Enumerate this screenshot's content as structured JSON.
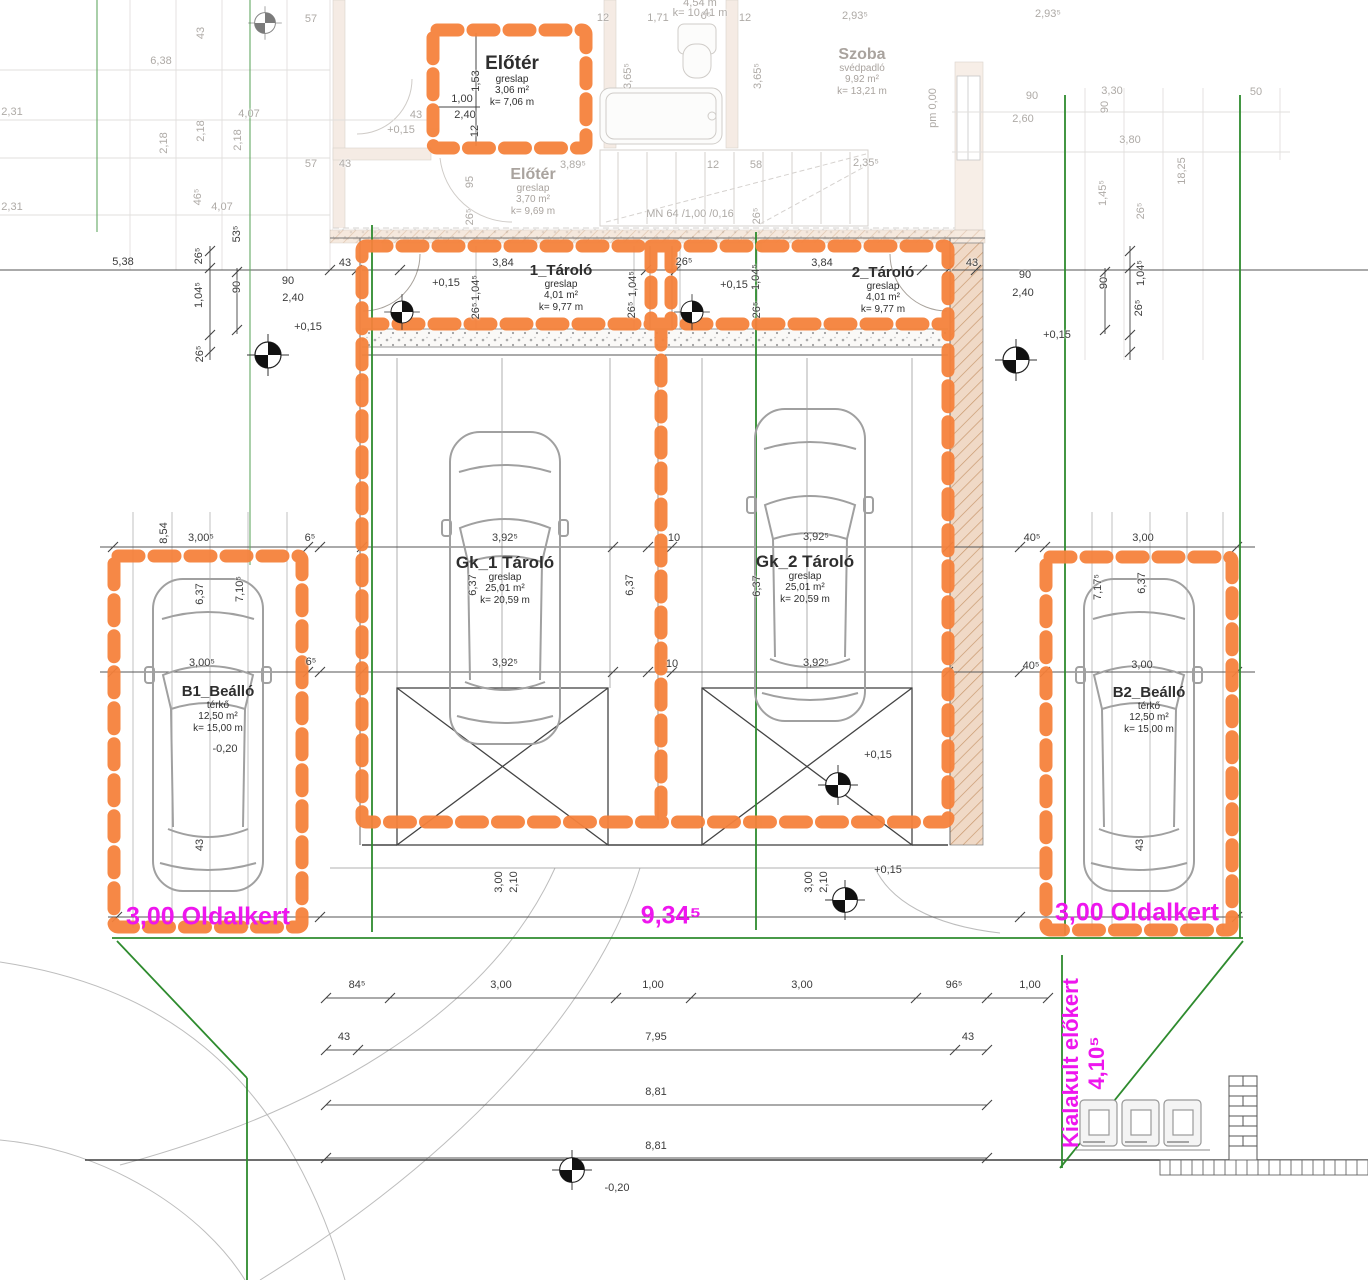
{
  "title": "Site / garage floor plan (Hungarian)",
  "colors": {
    "orange": "#F5823C",
    "magenta": "#EE16EE",
    "green": "#2E8B2E",
    "dim_dark": "#3B3B3B",
    "dim_faded": "#AEAAA6",
    "wall_tan": "#F0D9C6"
  },
  "rooms": [
    {
      "name": "room-elotere-upper",
      "cls": "elot",
      "title": "Előtér",
      "lines": [
        "greslap",
        "3,06 m²",
        "k= 7,06 m"
      ],
      "x": 512,
      "y": 54
    },
    {
      "name": "room-elotere-lower",
      "cls": "fade",
      "title": "Előtér",
      "lines": [
        "greslap",
        "3,70 m²",
        "k= 9,69 m"
      ],
      "x": 533,
      "y": 166
    },
    {
      "name": "room-szoba",
      "cls": "fade",
      "title": "Szoba",
      "lines": [
        "svédpadló",
        "9,92 m²",
        "k= 13,21 m"
      ],
      "x": 862,
      "y": 46
    },
    {
      "name": "room-tarolo-1",
      "cls": "",
      "title": "1_Tároló",
      "lines": [
        "greslap",
        "4,01 m²",
        "k= 9,77 m"
      ],
      "x": 561,
      "y": 262
    },
    {
      "name": "room-tarolo-2",
      "cls": "",
      "title": "2_Tároló",
      "lines": [
        "greslap",
        "4,01 m²",
        "k= 9,77 m"
      ],
      "x": 883,
      "y": 264
    },
    {
      "name": "room-gk1-tarolo",
      "cls": "big",
      "title": "Gk_1 Tároló",
      "lines": [
        "greslap",
        "25,01 m²",
        "k= 20,59 m"
      ],
      "x": 505,
      "y": 553
    },
    {
      "name": "room-gk2-tarolo",
      "cls": "big",
      "title": "Gk_2 Tároló",
      "lines": [
        "greslap",
        "25,01 m²",
        "k= 20,59 m"
      ],
      "x": 805,
      "y": 552
    },
    {
      "name": "room-b1-beallo",
      "cls": "",
      "title": "B1_Beálló",
      "lines": [
        "térkő",
        "12,50 m²",
        "k= 15,00 m"
      ],
      "x": 218,
      "y": 683
    },
    {
      "name": "room-b2-beallo",
      "cls": "",
      "title": "B2_Beálló",
      "lines": [
        "térkő",
        "12,50 m²",
        "k= 15,00 m"
      ],
      "x": 1149,
      "y": 684
    }
  ],
  "annotations": [
    {
      "name": "oldalkert-left-label",
      "text": "3,00 Oldalkert",
      "x": 208,
      "y": 917,
      "v": 0
    },
    {
      "name": "dim-9-34-label",
      "text": "9,34⁵",
      "x": 671,
      "y": 916,
      "v": 0
    },
    {
      "name": "oldalkert-right-label",
      "text": "3,00 Oldalkert",
      "x": 1137,
      "y": 913,
      "v": 0
    },
    {
      "name": "kialakult-elokert-label",
      "text": "Kialakult előkert",
      "x": 1071,
      "y": 1063,
      "v": 1
    },
    {
      "name": "dim-4-10-label",
      "text": "4,10⁵",
      "x": 1097,
      "y": 1063,
      "v": 1
    }
  ],
  "dims": [
    [
      "12",
      603,
      18,
      "f"
    ],
    [
      "1,71",
      658,
      18,
      "f"
    ],
    [
      "6⁵",
      706,
      16,
      "f"
    ],
    [
      "12",
      745,
      18,
      "f"
    ],
    [
      "2,93⁵",
      855,
      16,
      "f"
    ],
    [
      "2,93⁵",
      1048,
      14,
      "f"
    ],
    [
      "4,54 m",
      700,
      3,
      "f"
    ],
    [
      "k= 10,41 m",
      700,
      13,
      "f"
    ],
    [
      "3,65⁵",
      628,
      76,
      "vf"
    ],
    [
      "3,65⁵",
      758,
      76,
      "vf"
    ],
    [
      "pm 0,00",
      933,
      108,
      "vf"
    ],
    [
      "90",
      1032,
      96,
      "f"
    ],
    [
      "2,60",
      1023,
      119,
      "f"
    ],
    [
      "3,30",
      1112,
      91,
      "f"
    ],
    [
      "90",
      1105,
      107,
      "vf"
    ],
    [
      "50",
      1256,
      92,
      "f"
    ],
    [
      "3,80",
      1130,
      140,
      "f"
    ],
    [
      "1,45⁵",
      1103,
      193,
      "vf"
    ],
    [
      "26⁵",
      1141,
      211,
      "vf"
    ],
    [
      "18,25",
      1182,
      171,
      "vf"
    ],
    [
      "2,31",
      12,
      112,
      "f"
    ],
    [
      "2,31",
      12,
      207,
      "f"
    ],
    [
      "6,38",
      161,
      61,
      "f"
    ],
    [
      "43",
      201,
      33,
      "vf"
    ],
    [
      "57",
      311,
      19,
      "f"
    ],
    [
      "2,18",
      164,
      143,
      "vf"
    ],
    [
      "2,18",
      201,
      131,
      "vf"
    ],
    [
      "2,18",
      238,
      140,
      "vf"
    ],
    [
      "4,07",
      249,
      114,
      "f"
    ],
    [
      "57",
      311,
      164,
      "f"
    ],
    [
      "43",
      345,
      164,
      "f"
    ],
    [
      "+0,15",
      401,
      130,
      "f"
    ],
    [
      "43",
      416,
      115,
      "f"
    ],
    [
      "46⁵",
      198,
      197,
      "vf"
    ],
    [
      "4,07",
      222,
      207,
      "f"
    ],
    [
      "95",
      470,
      182,
      "vf"
    ],
    [
      "26⁵",
      470,
      217,
      "vf"
    ],
    [
      "3,89⁵",
      573,
      165,
      "f"
    ],
    [
      "12",
      713,
      165,
      "f"
    ],
    [
      "58",
      756,
      165,
      "f"
    ],
    [
      "2,35⁵",
      866,
      163,
      "f"
    ],
    [
      "26⁵",
      757,
      216,
      "vf"
    ],
    [
      "MN  64 /1,00 /0,16",
      690,
      214,
      "f"
    ],
    [
      "53⁵",
      237,
      234,
      "v"
    ],
    [
      "26⁵",
      199,
      256,
      "v"
    ],
    [
      "1,00",
      462,
      99,
      ""
    ],
    [
      "2,40",
      465,
      115,
      ""
    ],
    [
      "1,53",
      476,
      81,
      "v"
    ],
    [
      "12",
      475,
      131,
      "v"
    ],
    [
      "5,38",
      123,
      262,
      ""
    ],
    [
      "1,04⁵",
      199,
      295,
      "v"
    ],
    [
      "26⁵",
      200,
      354,
      "v"
    ],
    [
      "90",
      237,
      287,
      "v"
    ],
    [
      "90",
      288,
      281,
      ""
    ],
    [
      "2,40",
      293,
      298,
      ""
    ],
    [
      "+0,15",
      308,
      327,
      ""
    ],
    [
      "43",
      345,
      263,
      ""
    ],
    [
      "3,84",
      503,
      263,
      ""
    ],
    [
      "+0,15",
      446,
      283,
      ""
    ],
    [
      "1,04⁵",
      476,
      288,
      "v"
    ],
    [
      "26⁵",
      476,
      311,
      "v"
    ],
    [
      "1,04⁵",
      633,
      284,
      "v"
    ],
    [
      "26⁵",
      632,
      310,
      "v"
    ],
    [
      "26⁵",
      684,
      262,
      ""
    ],
    [
      "3,84",
      822,
      263,
      ""
    ],
    [
      "+0,15",
      734,
      285,
      ""
    ],
    [
      "1,04⁵",
      756,
      277,
      "v"
    ],
    [
      "26⁵",
      757,
      310,
      "v"
    ],
    [
      "43",
      972,
      263,
      ""
    ],
    [
      "90",
      1025,
      275,
      ""
    ],
    [
      "2,40",
      1023,
      293,
      ""
    ],
    [
      "90",
      1104,
      283,
      "v"
    ],
    [
      "1,04⁵",
      1141,
      273,
      "v"
    ],
    [
      "26⁵",
      1139,
      308,
      "v"
    ],
    [
      "+0,15",
      1057,
      335,
      ""
    ],
    [
      "8,54",
      164,
      533,
      "v"
    ],
    [
      "3,00⁵",
      201,
      538,
      ""
    ],
    [
      "6⁵",
      310,
      538,
      ""
    ],
    [
      "6,37",
      200,
      594,
      "v"
    ],
    [
      "7,10⁵",
      240,
      589,
      "v"
    ],
    [
      "3,00⁵",
      202,
      663,
      ""
    ],
    [
      "6⁵",
      311,
      662,
      ""
    ],
    [
      "3,92⁵",
      505,
      538,
      ""
    ],
    [
      "10",
      674,
      538,
      ""
    ],
    [
      "6,37",
      473,
      585,
      "v"
    ],
    [
      "6,37",
      630,
      585,
      "v"
    ],
    [
      "3,92⁵",
      505,
      663,
      ""
    ],
    [
      "10",
      672,
      664,
      ""
    ],
    [
      "3,92⁵",
      816,
      537,
      ""
    ],
    [
      "6,37",
      757,
      586,
      "v"
    ],
    [
      "3,92⁵",
      816,
      663,
      ""
    ],
    [
      "40⁵",
      1032,
      538,
      ""
    ],
    [
      "3,00",
      1143,
      538,
      ""
    ],
    [
      "7,17⁵",
      1098,
      587,
      "v"
    ],
    [
      "6,37",
      1142,
      583,
      "v"
    ],
    [
      "40⁵",
      1031,
      666,
      ""
    ],
    [
      "3,00",
      1142,
      665,
      ""
    ],
    [
      "-0,20",
      225,
      749,
      ""
    ],
    [
      "+0,15",
      878,
      755,
      ""
    ],
    [
      "+0,15",
      888,
      870,
      ""
    ],
    [
      "43",
      200,
      845,
      "v"
    ],
    [
      "43",
      1140,
      845,
      "v"
    ],
    [
      "3,00",
      499,
      882,
      "v"
    ],
    [
      "2,10",
      514,
      882,
      "v"
    ],
    [
      "3,00",
      809,
      882,
      "v"
    ],
    [
      "2,10",
      824,
      882,
      "v"
    ],
    [
      "84⁵",
      357,
      985,
      ""
    ],
    [
      "3,00",
      501,
      985,
      ""
    ],
    [
      "1,00",
      653,
      985,
      ""
    ],
    [
      "3,00",
      802,
      985,
      ""
    ],
    [
      "96⁵",
      954,
      985,
      ""
    ],
    [
      "1,00",
      1030,
      985,
      ""
    ],
    [
      "43",
      344,
      1037,
      ""
    ],
    [
      "7,95",
      656,
      1037,
      ""
    ],
    [
      "43",
      968,
      1037,
      ""
    ],
    [
      "8,81",
      656,
      1092,
      ""
    ],
    [
      "8,81",
      656,
      1146,
      ""
    ],
    [
      "-0,20",
      617,
      1188,
      ""
    ]
  ]
}
